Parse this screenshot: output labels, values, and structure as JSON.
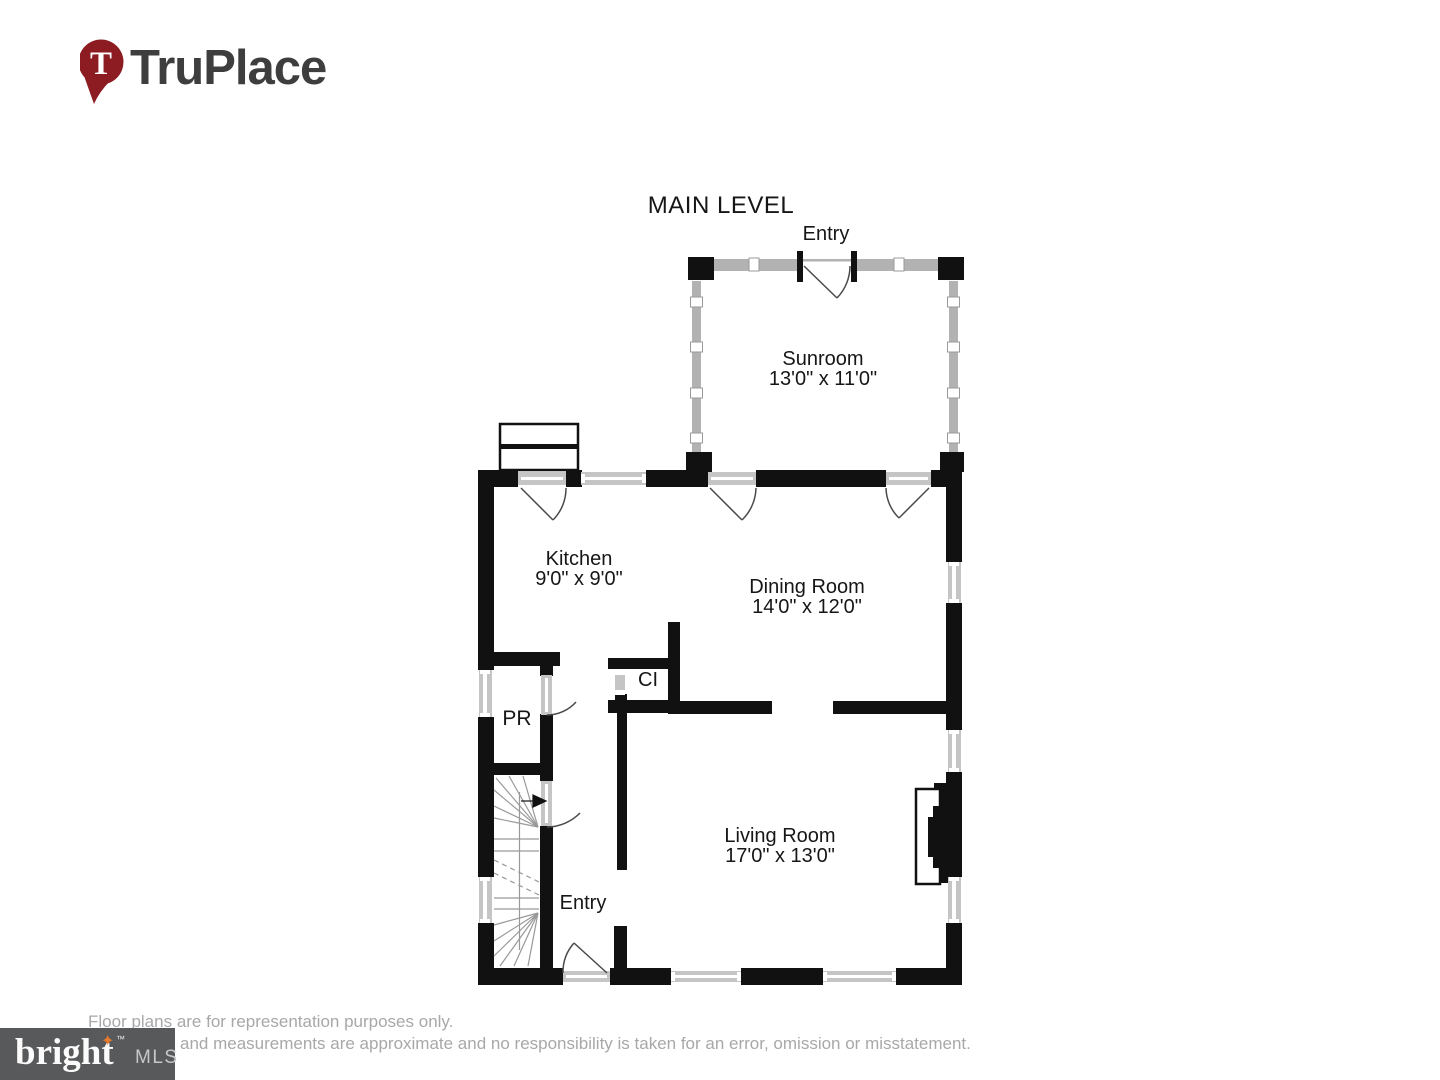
{
  "branding": {
    "logo_text": "TruPlace",
    "pin_letter": "T"
  },
  "plan": {
    "title": "MAIN LEVEL",
    "labels": {
      "entry_top": "Entry",
      "entry_bottom": "Entry",
      "pr": "PR",
      "ci": "CI"
    },
    "rooms": [
      {
        "name": "Sunroom",
        "dims": "13'0\" x 11'0\""
      },
      {
        "name": "Kitchen",
        "dims": "9'0\" x 9'0\""
      },
      {
        "name": "Dining Room",
        "dims": "14'0\" x 12'0\""
      },
      {
        "name": "Living Room",
        "dims": "17'0\" x 13'0\""
      }
    ]
  },
  "footer": {
    "disclaimer_line1": "Floor plans are for representation purposes only.",
    "disclaimer_line2": "and measurements are approximate and no responsibility is taken for an error, omission or misstatement.",
    "mls_word": "bright",
    "mls_star": "✦",
    "mls_tm": "™",
    "mls_suffix": "MLS"
  },
  "colors": {
    "wall": "#111111",
    "window-gray": "#c5c5c5",
    "sunroom-gray": "#b2b2b2",
    "door-line": "#4a4a4a",
    "stair-line": "#999999",
    "truplace-red": "#8c1b22",
    "star-orange": "#e87a2d",
    "mls-gray": "#58595b",
    "disclaimer-gray": "#a8a8a8"
  }
}
